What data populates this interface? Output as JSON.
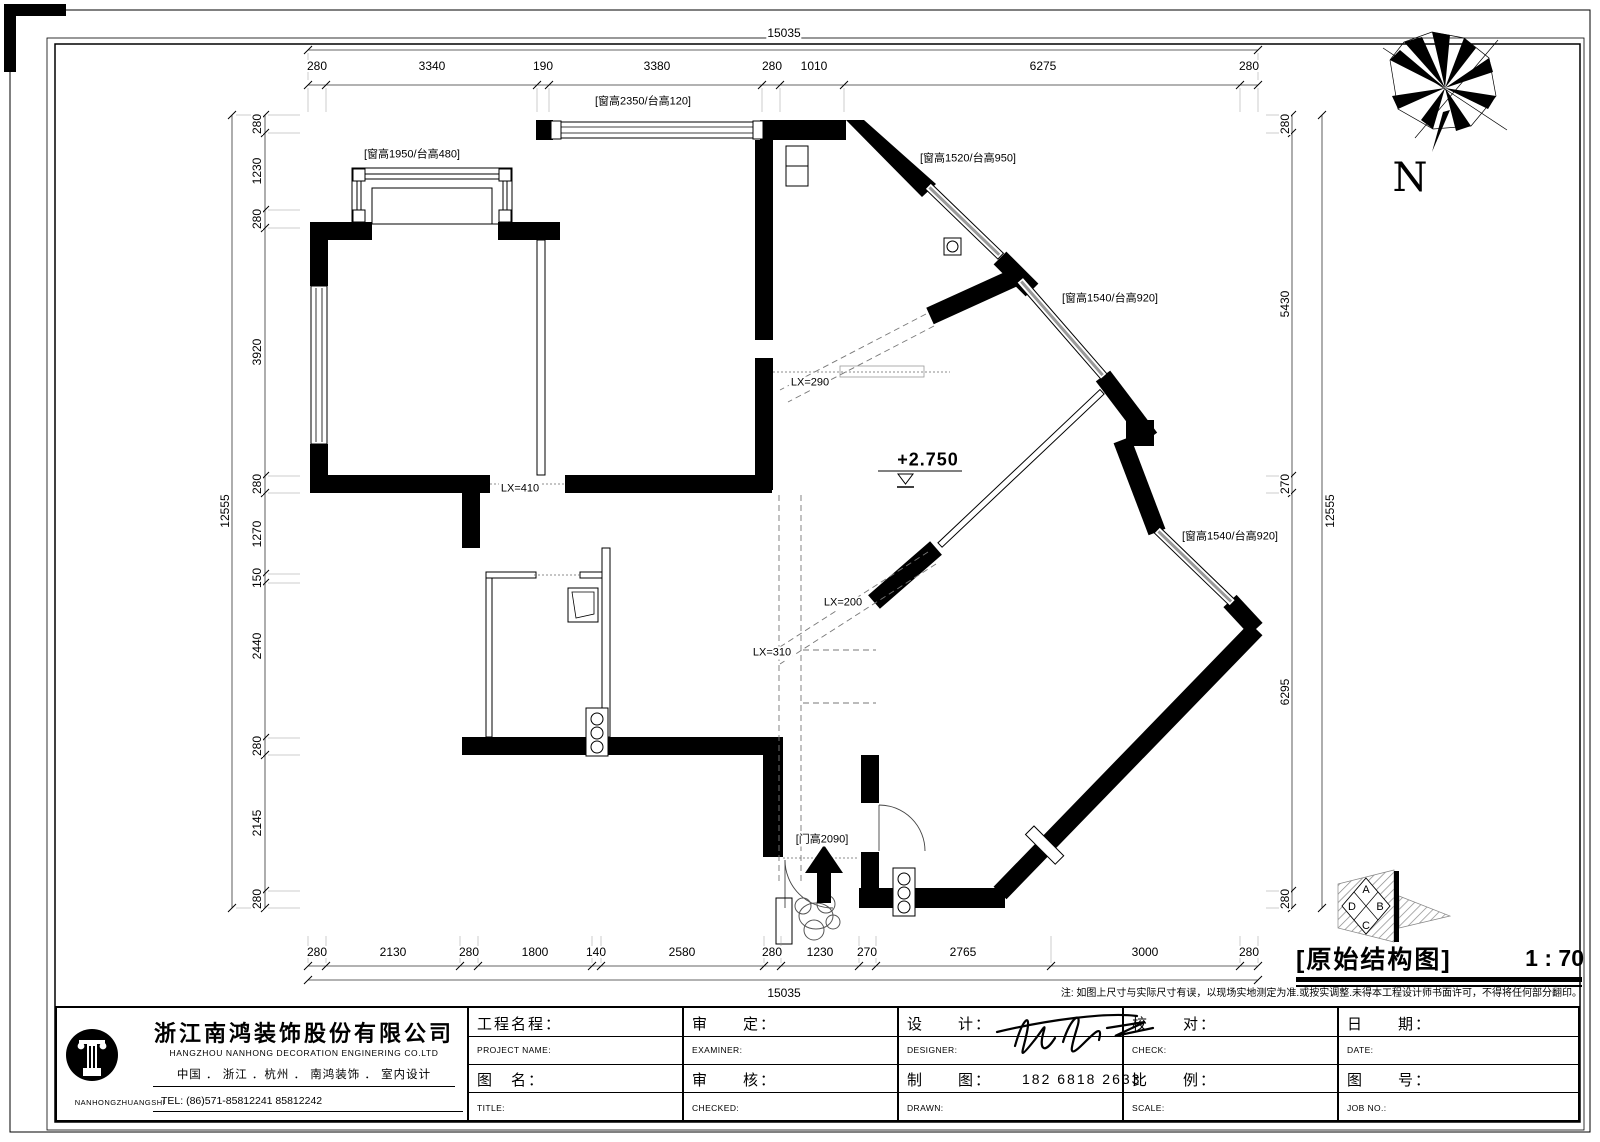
{
  "dims": {
    "total": "15035",
    "total_v": "12555",
    "top": [
      "280",
      "3340",
      "190",
      "3380",
      "280",
      "1010",
      "6275",
      "280"
    ],
    "bottom": [
      "280",
      "2130",
      "280",
      "1800",
      "140",
      "2580",
      "280",
      "1230",
      "270",
      "2765",
      "3000",
      "280"
    ],
    "left": [
      "280",
      "1230",
      "280",
      "3920",
      "280",
      "1270",
      "150",
      "2440",
      "280",
      "2145",
      "280"
    ],
    "right": [
      "280",
      "5430",
      "270",
      "6295",
      "280"
    ]
  },
  "labels": {
    "win_a": "[窗高2350/台高120]",
    "win_b": "[窗高1950/台高480]",
    "win_c": "[窗高1520/台高950]",
    "win_d": "[窗高1540/台高920]",
    "win_e": "[窗高1540/台高920]",
    "door": "[门高2090]",
    "level": "+2.750",
    "lx290": "LX=290",
    "lx410": "LX=410",
    "lx200": "LX=200",
    "lx310": "LX=310"
  },
  "compass": {
    "n": "N"
  },
  "elev": {
    "a": "A",
    "b": "B",
    "c": "C",
    "d": "D"
  },
  "title": {
    "name": "[原始结构图]",
    "scale": "1 : 70"
  },
  "note": "注: 如图上尺寸与实际尺寸有误，以现场实地测定为准.或按实调整.未得本工程设计师书面许可，不得将任何部分翻印。",
  "company": {
    "name_cn": "浙江南鸿装饰股份有限公司",
    "name_en": "HANGZHOU  NANHONG  DECORATION  ENGINERING  CO.LTD",
    "line2": "中国 ． 浙江 ．杭州 ．      南鸿装饰 ． 室内设计",
    "tel": "TEL:   (86)571-85812241   85812242",
    "logo_text": "NANHONGZHUANGSHI"
  },
  "tb": {
    "c1r1_cn": "工程名程：",
    "c1r1_en": "PROJECT NAME:",
    "c1r2_cn": "图　名：",
    "c1r2_en": "TITLE:",
    "c2r1_cn": "审　　定：",
    "c2r1_en": "EXAMINER:",
    "c2r2_cn": "审　　核：",
    "c2r2_en": "CHECKED:",
    "c3r1_cn": "设　　计：",
    "c3r1_en": "DESIGNER:",
    "c3r2_cn": "制　　图：",
    "c3r2_en": "DRAWN:",
    "c3r2_val": "182 6818 2633",
    "c4r1_cn": "校　　对：",
    "c4r1_en": "CHECK:",
    "c4r2_cn": "比　　例：",
    "c4r2_en": "SCALE:",
    "c5r1_cn": "日　　期：",
    "c5r1_en": "DATE:",
    "c5r2_cn": "图　　号：",
    "c5r2_en": "JOB  NO.:"
  }
}
